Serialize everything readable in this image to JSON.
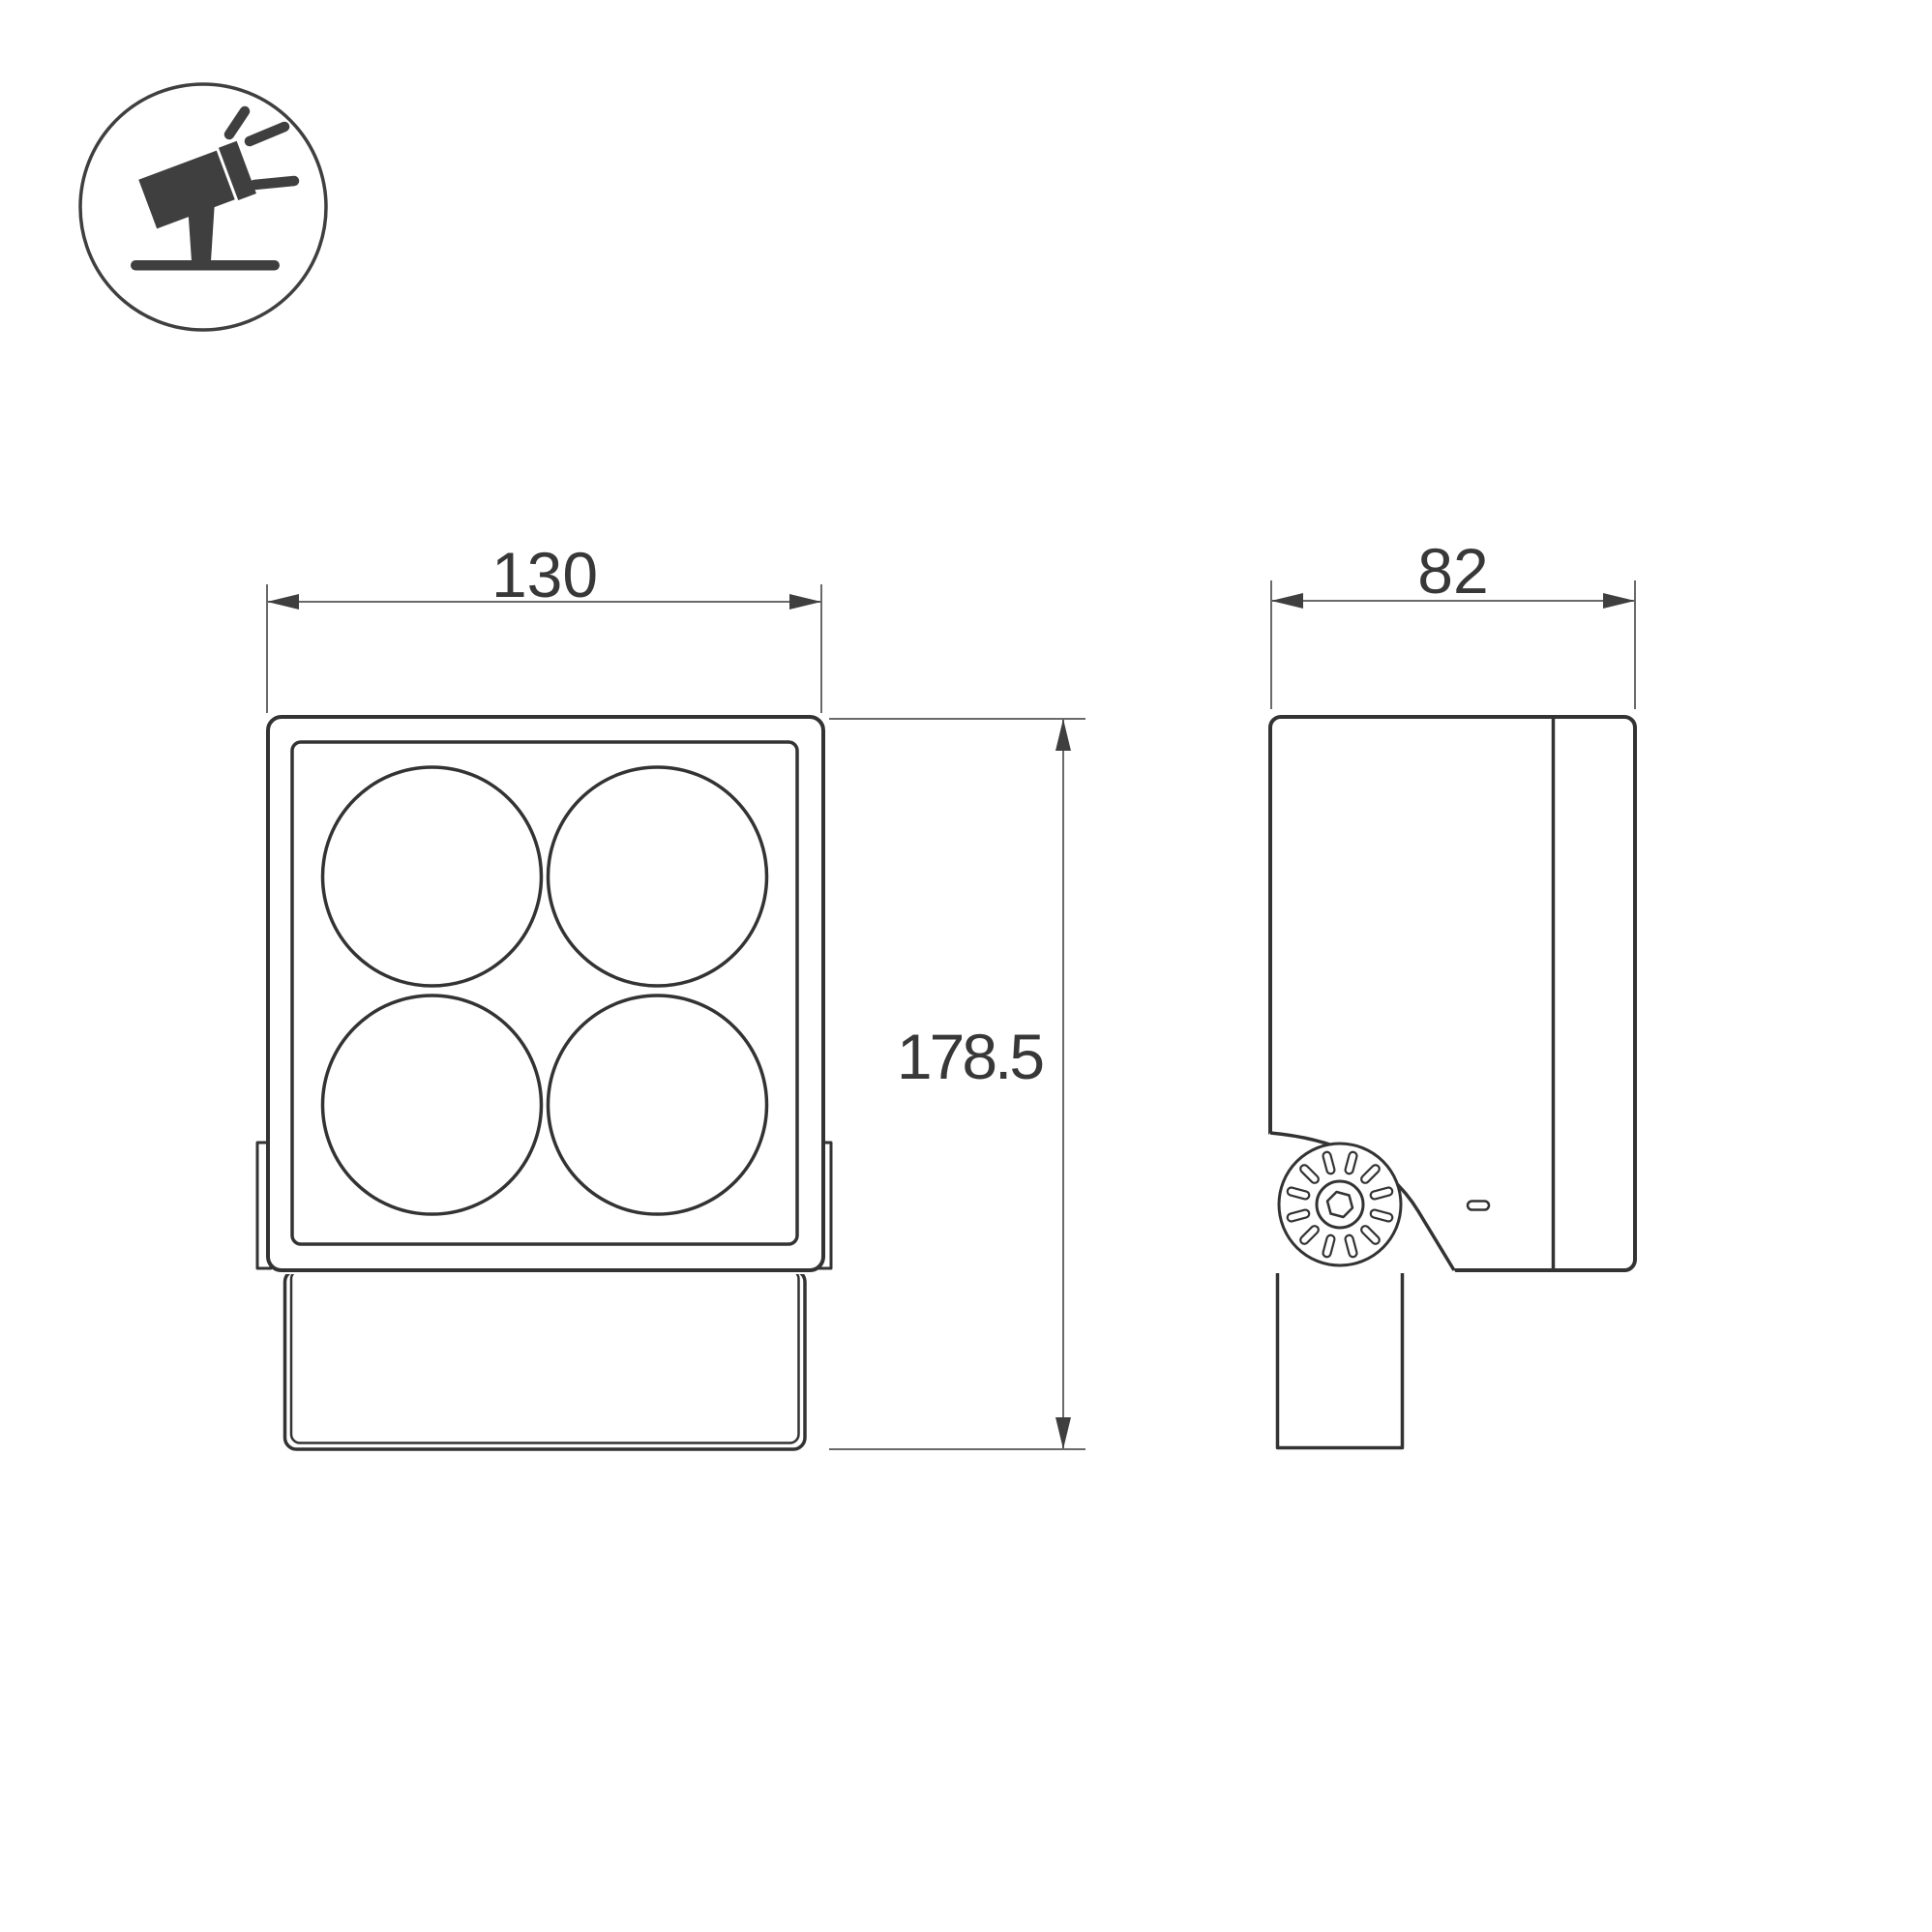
{
  "icon": {
    "name": "tilted-floodlight-on-base",
    "meaning": "adjustable spotlight product type pictogram"
  },
  "dimensions": {
    "front_width": "130",
    "depth": "82",
    "height": "178.5"
  },
  "views": {
    "front": {
      "lens_count": 4
    },
    "side": {
      "knob_slot_count": 12
    }
  },
  "colors": {
    "background": "#ffffff",
    "outline": "#333333",
    "dimension_line": "#6a6a6a",
    "arrow": "#3f3f3f",
    "text": "#383838",
    "icon": "#3f3f3f"
  }
}
